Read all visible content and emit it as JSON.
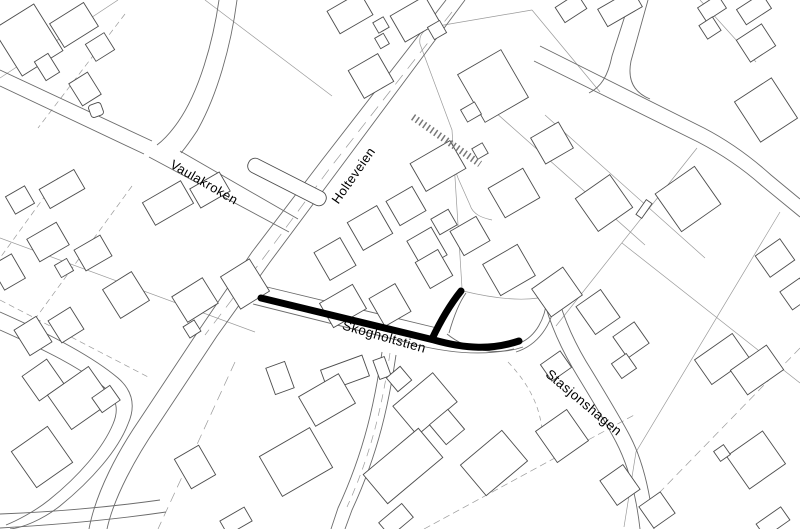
{
  "map": {
    "width": 800,
    "height": 529,
    "colors": {
      "background": "#ffffff",
      "parcel": "#9a9a9a",
      "road": "#6b6b6b",
      "building": "#4d4d4d",
      "building_fill": "#ffffff",
      "hatch": "#777777",
      "highlight": "#000000",
      "label": "#000000"
    },
    "labels": [
      {
        "id": "vaulakroken",
        "text": "Vaulakroken",
        "x": 202,
        "y": 186,
        "angle": 30,
        "size": 13
      },
      {
        "id": "holteveien",
        "text": "Holteveien",
        "x": 357,
        "y": 178,
        "angle": -55,
        "size": 13
      },
      {
        "id": "skogholtstien",
        "text": "Skogholtstien",
        "x": 383,
        "y": 341,
        "angle": 16,
        "size": 13.5
      },
      {
        "id": "stasjonshagen",
        "text": "Stasjonshagen",
        "x": 581,
        "y": 406,
        "angle": 40,
        "size": 13.5
      }
    ],
    "highlight": {
      "width": 7,
      "paths": [
        "M261,298 L434,340 C466,349 492,350 519,341",
        "M432,339 C440,322 449,306 461,291"
      ]
    },
    "roads": [
      {
        "d": "M0,70 L152,141"
      },
      {
        "d": "M0,86 L144,154"
      },
      {
        "d": "M219,0 C213,42 199,92 178,122 C171,132 165,139 157,145"
      },
      {
        "d": "M237,0 C231,46 217,96 197,131 C191,140 186,147 181,153"
      },
      {
        "d": "M180,151 L298,219"
      },
      {
        "d": "M149,157 L289,232"
      },
      {
        "d": "M446,0 L322,160 L252,252 L199,330 C180,359 160,389 140,419 C118,451 96,492 89,529"
      },
      {
        "d": "M465,0 L340,168 L270,262 L217,336 C198,365 178,395 158,425 C136,457 114,497 107,529"
      },
      {
        "d": "M267,287 L437,328"
      },
      {
        "d": "M253,304 L417,345 C450,353 484,356 514,349"
      },
      {
        "d": "M449,333 C453,319 458,304 466,293"
      },
      {
        "d": "M447,334 C468,351 498,356 523,347"
      },
      {
        "d": "M520,343 C536,336 545,319 547,299"
      },
      {
        "d": "M516,352 C538,345 552,325 555,301"
      },
      {
        "d": "M382,352 C375,400 365,450 338,508 L331,529"
      },
      {
        "d": "M396,355 C389,402 379,452 352,510 L345,529"
      },
      {
        "d": "M543,297 C550,325 562,351 578,377 C592,400 606,423 616,442 C628,465 636,494 640,529"
      },
      {
        "d": "M557,293 C564,320 576,346 592,371 C606,394 620,417 630,436 C642,459 650,489 654,529"
      },
      {
        "d": "M540,46 L704,128 C729,141 751,157 771,175 L800,199"
      },
      {
        "d": "M534,61 L698,142 C721,154 743,169 761,185 L800,217"
      },
      {
        "d": "M630,0 L612,56 C608,76 601,87 589,93"
      },
      {
        "d": "M648,0 L631,61 C627,81 635,93 650,99"
      },
      {
        "d": "M0,312 C50,334 92,356 118,378 C133,391 136,406 128,424 C118,450 92,480 60,506 C42,520 22,528 10,529"
      },
      {
        "d": "M0,330 C45,350 81,368 105,388 C117,399 119,410 113,424 C103,448 79,476 49,500 C34,512 16,521 6,525"
      },
      {
        "d": "M0,514 C52,512 110,507 160,500"
      },
      {
        "d": "M0,528 C52,525 112,520 166,512"
      }
    ],
    "parcel_lines": [
      {
        "d": "M205,0 L332,96"
      },
      {
        "d": "M118,0 L0,78"
      },
      {
        "d": "M125,14 L38,128",
        "dash": "6 4"
      },
      {
        "d": "M420,44 C418,32 428,27 438,26 L532,10"
      },
      {
        "d": "M532,10 L600,92"
      },
      {
        "d": "M420,44 L452,130 L462,288"
      },
      {
        "d": "M463,291 C500,300 530,302 552,295"
      },
      {
        "d": "M459,154 C452,160 455,170 458,178 L470,205 C473,215 483,218 492,220"
      },
      {
        "d": "M468,88 L645,245"
      },
      {
        "d": "M545,115 L705,258"
      },
      {
        "d": "M697,148 L556,326"
      },
      {
        "d": "M622,243 L800,383"
      },
      {
        "d": "M780,212 L636,452 L624,527"
      },
      {
        "d": "M800,348 L660,492",
        "dash": "8 5"
      },
      {
        "d": "M424,529 L636,414",
        "dash": "7 4"
      },
      {
        "d": "M508,362 C530,385 540,408 542,430",
        "dash": "5 4"
      },
      {
        "d": "M0,238 L255,332"
      },
      {
        "d": "M58,178 L0,258",
        "dash": "6 4"
      },
      {
        "d": "M132,186 L30,326",
        "dash": "6 4"
      },
      {
        "d": "M0,300 L150,378",
        "dash": "6 4"
      },
      {
        "d": "M235,362 L158,529",
        "dash": "10 6"
      },
      {
        "d": "M390,353 C383,400 373,450 347,507",
        "dash": "8 6"
      },
      {
        "d": "M452,12 L330,168 L262,260 L205,335",
        "dash": "12 8"
      },
      {
        "d": "M700,0 L756,62"
      }
    ],
    "hatch_bands": [
      {
        "d": "M413,117 L480,164",
        "w": 7,
        "dash": "1.5 3"
      }
    ],
    "buildings": [
      {
        "r": [
          28,
          40,
          48,
          55,
          -32
        ]
      },
      {
        "r": [
          74,
          25,
          40,
          28,
          -32
        ]
      },
      {
        "r": [
          100,
          47,
          22,
          20,
          -32
        ]
      },
      {
        "r": [
          47,
          67,
          16,
          22,
          -32
        ]
      },
      {
        "r": [
          85,
          89,
          22,
          26,
          -32
        ]
      },
      {
        "r": [
          96,
          110,
          13,
          13,
          -20
        ],
        "rx": 3
      },
      {
        "r": [
          62,
          189,
          40,
          22,
          -30
        ]
      },
      {
        "r": [
          20,
          200,
          22,
          20,
          -30
        ]
      },
      {
        "r": [
          168,
          203,
          44,
          26,
          -30
        ]
      },
      {
        "r": [
          210,
          190,
          34,
          22,
          -30
        ]
      },
      {
        "r": [
          48,
          242,
          34,
          26,
          -30
        ]
      },
      {
        "r": [
          93,
          253,
          30,
          24,
          -30
        ]
      },
      {
        "r": [
          64,
          268,
          14,
          14,
          -30
        ]
      },
      {
        "r": [
          8,
          272,
          24,
          28,
          -30
        ]
      },
      {
        "r": [
          126,
          295,
          34,
          34,
          -32
        ]
      },
      {
        "r": [
          195,
          300,
          36,
          30,
          -32
        ]
      },
      {
        "r": [
          245,
          284,
          34,
          38,
          -32
        ]
      },
      {
        "r": [
          192,
          329,
          13,
          13,
          -32
        ]
      },
      {
        "r": [
          33,
          336,
          26,
          30,
          -32
        ]
      },
      {
        "r": [
          66,
          325,
          26,
          26,
          -32
        ]
      },
      {
        "r": [
          287,
          182,
          86,
          15,
          27
        ],
        "rx": 7
      },
      {
        "r": [
          350,
          13,
          38,
          26,
          -30
        ]
      },
      {
        "r": [
          381,
          25,
          12,
          12,
          -30
        ]
      },
      {
        "r": [
          382,
          41,
          10,
          12,
          -30
        ]
      },
      {
        "r": [
          415,
          19,
          40,
          30,
          -30
        ]
      },
      {
        "r": [
          437,
          30,
          14,
          14,
          -30
        ]
      },
      {
        "r": [
          371,
          76,
          34,
          32,
          -30
        ]
      },
      {
        "r": [
          493,
          86,
          50,
          55,
          -30
        ]
      },
      {
        "r": [
          471,
          112,
          16,
          14,
          -30
        ]
      },
      {
        "r": [
          571,
          8,
          26,
          18,
          -33
        ]
      },
      {
        "r": [
          620,
          8,
          40,
          20,
          -30
        ]
      },
      {
        "r": [
          712,
          8,
          24,
          16,
          -33
        ]
      },
      {
        "r": [
          754,
          9,
          30,
          18,
          -33
        ]
      },
      {
        "r": [
          710,
          28,
          16,
          16,
          -33
        ]
      },
      {
        "r": [
          756,
          43,
          30,
          26,
          -33
        ]
      },
      {
        "r": [
          766,
          110,
          44,
          48,
          -33
        ]
      },
      {
        "r": [
          604,
          203,
          42,
          40,
          -35
        ]
      },
      {
        "r": [
          688,
          199,
          48,
          46,
          -35
        ]
      },
      {
        "r": [
          644,
          209,
          18,
          7,
          -55
        ]
      },
      {
        "r": [
          775,
          258,
          30,
          26,
          -35
        ]
      },
      {
        "r": [
          796,
          294,
          24,
          22,
          -35
        ]
      },
      {
        "r": [
          722,
          359,
          46,
          30,
          -35
        ]
      },
      {
        "r": [
          335,
          259,
          30,
          32,
          -30
        ]
      },
      {
        "r": [
          370,
          228,
          34,
          32,
          -30
        ]
      },
      {
        "r": [
          406,
          206,
          30,
          28,
          -30
        ]
      },
      {
        "r": [
          427,
          248,
          28,
          32,
          -30
        ]
      },
      {
        "r": [
          343,
          306,
          38,
          28,
          -30
        ]
      },
      {
        "r": [
          390,
          305,
          30,
          32,
          -30
        ]
      },
      {
        "r": [
          434,
          269,
          26,
          30,
          -30
        ]
      },
      {
        "r": [
          438,
          166,
          46,
          32,
          -30
        ]
      },
      {
        "r": [
          480,
          151,
          12,
          12,
          -30
        ]
      },
      {
        "r": [
          514,
          193,
          40,
          34,
          -30
        ]
      },
      {
        "r": [
          552,
          143,
          32,
          30,
          -30
        ]
      },
      {
        "r": [
          470,
          236,
          30,
          28,
          -30
        ]
      },
      {
        "r": [
          444,
          222,
          20,
          18,
          -30
        ]
      },
      {
        "r": [
          509,
          270,
          40,
          36,
          -30
        ]
      },
      {
        "r": [
          557,
          292,
          38,
          34,
          -35
        ]
      },
      {
        "r": [
          598,
          312,
          30,
          34,
          -35
        ]
      },
      {
        "r": [
          631,
          340,
          26,
          26,
          -35
        ]
      },
      {
        "r": [
          624,
          366,
          18,
          18,
          -35
        ]
      },
      {
        "r": [
          43,
          380,
          30,
          30,
          -35
        ]
      },
      {
        "r": [
          80,
          398,
          50,
          42,
          -35
        ]
      },
      {
        "r": [
          106,
          399,
          22,
          18,
          -35
        ]
      },
      {
        "r": [
          42,
          457,
          44,
          44,
          -35
        ]
      },
      {
        "r": [
          195,
          467,
          28,
          34,
          -30
        ]
      },
      {
        "r": [
          236,
          521,
          28,
          16,
          -30
        ]
      },
      {
        "r": [
          280,
          378,
          20,
          28,
          -20
        ]
      },
      {
        "r": [
          345,
          373,
          44,
          22,
          -20
        ]
      },
      {
        "r": [
          382,
          368,
          12,
          20,
          -20
        ]
      },
      {
        "r": [
          399,
          379,
          18,
          18,
          -40
        ]
      },
      {
        "r": [
          327,
          400,
          46,
          34,
          -30
        ]
      },
      {
        "r": [
          296,
          462,
          58,
          46,
          -30
        ]
      },
      {
        "r": [
          425,
          404,
          52,
          38,
          -40
        ]
      },
      {
        "r": [
          447,
          427,
          24,
          26,
          -40
        ]
      },
      {
        "r": [
          403,
          466,
          72,
          38,
          -40
        ]
      },
      {
        "r": [
          494,
          463,
          54,
          40,
          -40
        ]
      },
      {
        "r": [
          396,
          520,
          30,
          18,
          -40
        ]
      },
      {
        "r": [
          562,
          436,
          38,
          38,
          -35
        ]
      },
      {
        "r": [
          620,
          485,
          28,
          30,
          -35
        ]
      },
      {
        "r": [
          657,
          510,
          26,
          26,
          -35
        ]
      },
      {
        "r": [
          556,
          366,
          24,
          20,
          -35
        ]
      },
      {
        "r": [
          757,
          370,
          44,
          30,
          -35
        ]
      },
      {
        "r": [
          756,
          460,
          44,
          40,
          -35
        ]
      },
      {
        "r": [
          722,
          453,
          12,
          12,
          -35
        ]
      },
      {
        "r": [
          773,
          522,
          30,
          16,
          -35
        ]
      }
    ]
  }
}
